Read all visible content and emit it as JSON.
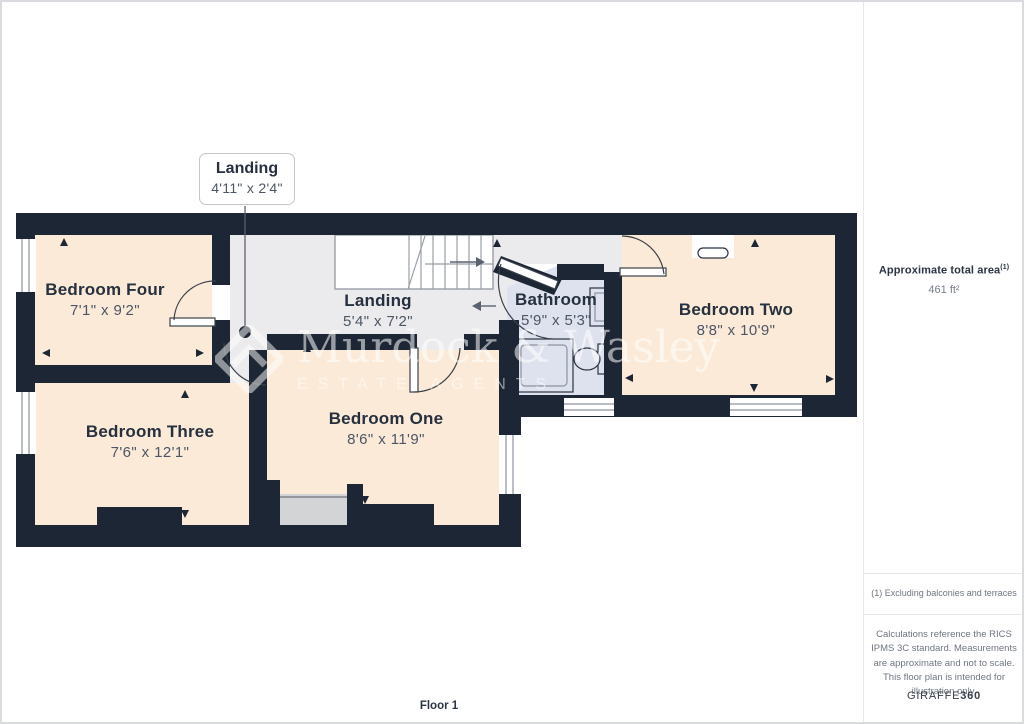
{
  "page": {
    "floor_label": "Floor 1"
  },
  "callout": {
    "title": "Landing",
    "dims": "4'11\" x 2'4\""
  },
  "rooms": [
    {
      "name": "Bedroom Four",
      "dims": "7'1\" x 9'2\""
    },
    {
      "name": "Landing",
      "dims": "5'4\" x 7'2\""
    },
    {
      "name": "Bathroom",
      "dims": "5'9\" x 5'3\""
    },
    {
      "name": "Bedroom Two",
      "dims": "8'8\" x 10'9\""
    },
    {
      "name": "Bedroom Three",
      "dims": "7'6\" x 12'1\""
    },
    {
      "name": "Bedroom One",
      "dims": "8'6\" x 11'9\""
    }
  ],
  "watermark": {
    "name": "Murdock & Wasley",
    "tagline": "ESTATE AGENTS"
  },
  "sidebar": {
    "area_label": "Approximate total area",
    "area_note_ref": "(1)",
    "area_value": "461 ft²",
    "footnote": "(1) Excluding balconies and terraces",
    "disclaimer": "Calculations reference the RICS IPMS 3C standard. Measurements are approximate and not to scale. This floor plan is intended for illustration only.",
    "brand_name": "GIRAFFE",
    "brand_suffix": "360"
  },
  "colors": {
    "wall": "#1d2634",
    "room_fill": "#fbead7",
    "landing_fill": "#ebebed",
    "bathroom_fill": "#dde2ee",
    "recess_fill": "#d3d4d6"
  }
}
